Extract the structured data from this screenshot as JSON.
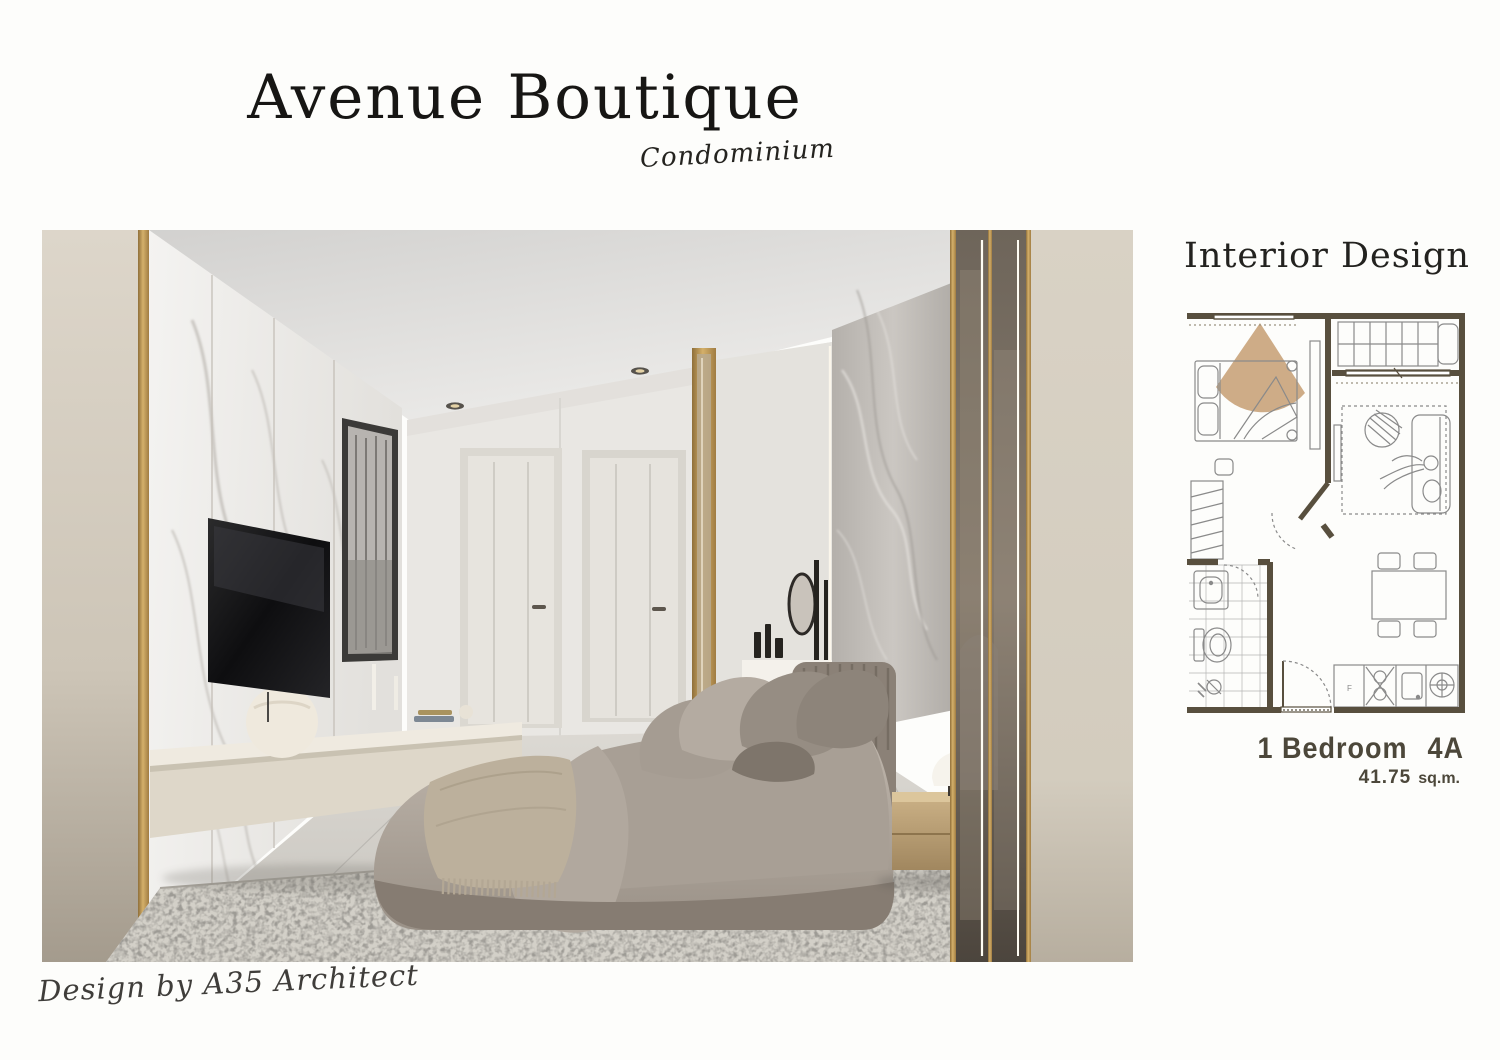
{
  "header": {
    "title": "Avenue Boutique",
    "subtitle": "Condominium"
  },
  "interior": {
    "heading": "Interior Design"
  },
  "unit": {
    "type": "1 Bedroom",
    "code": "4A",
    "area": "41.75",
    "area_unit": "sq.m."
  },
  "footer": {
    "credit": "Design by A35 Architect"
  },
  "photo": {
    "description": "Rendered bedroom interior: white marble TV wall with floating cream console and sphere vase, two white panel doors, grey velvet channel-tufted bed with beige throw, grey marble feature wall, bronze glass partition with gold trim, distressed grey rug on marble floor"
  },
  "floor_plan": {
    "rooms": [
      "bedroom",
      "balcony",
      "living-area",
      "wardrobe",
      "bathroom",
      "dining-area",
      "kitchen",
      "entrance"
    ],
    "camera_view_marker": "bedroom-view-cone"
  },
  "colors": {
    "accent_gold": "#b08d4f",
    "plan_wall": "#584f3e",
    "view_cone": "#c7a176",
    "wall_beige": "#d6cfc2",
    "text_dark": "#4c473a"
  }
}
